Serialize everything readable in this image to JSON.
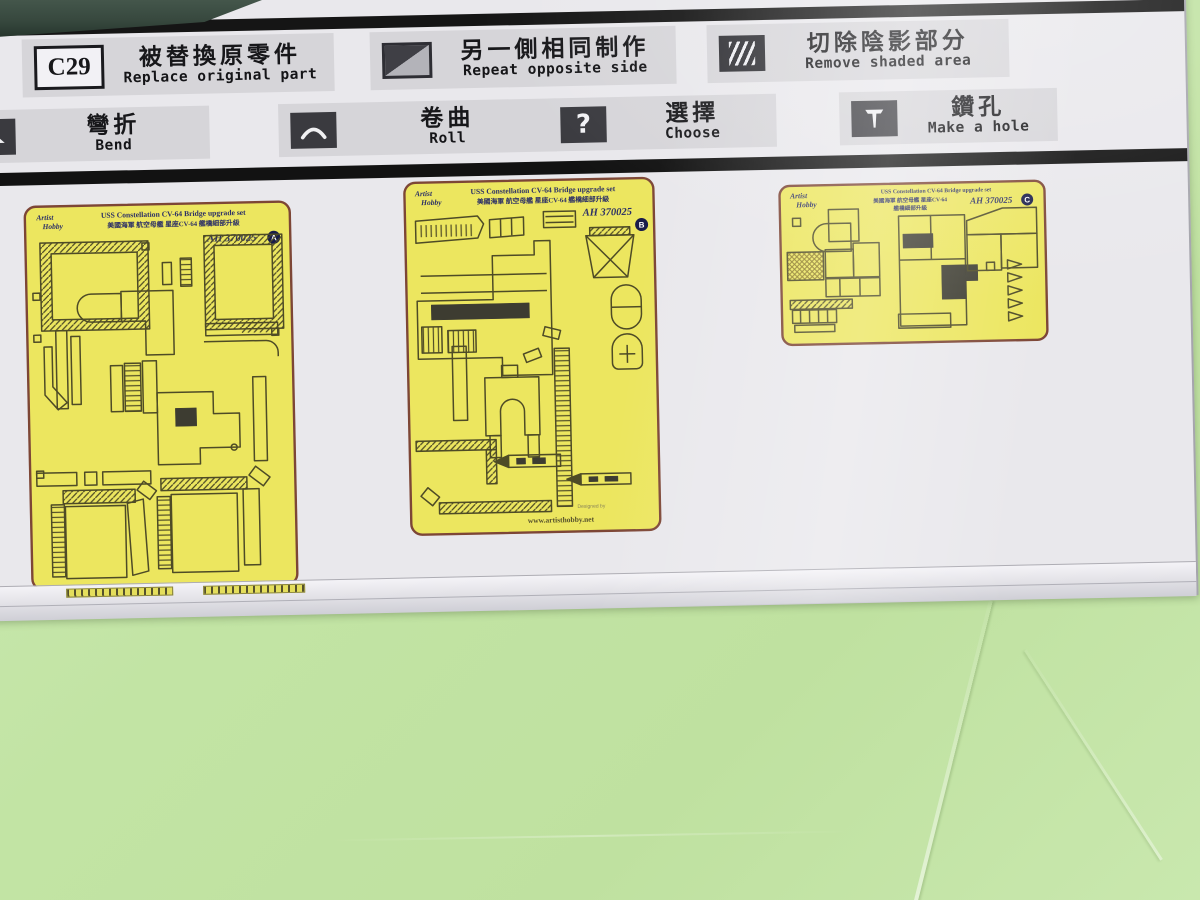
{
  "scene": {
    "background_color": "#c2e4a4",
    "sheet_color": "#e9e8ec",
    "fret_color": "#ece65f",
    "accent_navy": "#2c3066"
  },
  "legend": {
    "row1": [
      {
        "symbol": "C29",
        "zh": "被替換原零件",
        "en": "Replace original part",
        "icon": "part-number-box-icon"
      },
      {
        "zh": "另一側相同制作",
        "en": "Repeat opposite side",
        "icon": "diagonal-split-square-icon"
      },
      {
        "zh": "切除陰影部分",
        "en": "Remove shaded area",
        "icon": "hatched-square-icon"
      }
    ],
    "row2": [
      {
        "zh": "彎折",
        "en": "Bend",
        "icon": "bend-icon"
      },
      {
        "zh": "卷曲",
        "en": "Roll",
        "icon": "roll-icon"
      },
      {
        "zh": "選擇",
        "en": "Choose",
        "icon": "question-mark-icon",
        "glyph": "?"
      },
      {
        "zh": "鑽孔",
        "en": "Make a hole",
        "icon": "drill-icon"
      }
    ]
  },
  "frets": {
    "brand": {
      "line1": "Artist",
      "line2": "Hobby"
    },
    "a": {
      "title_en": "USS Constellation CV-64 Bridge upgrade set",
      "title_zh": "美國海軍 航空母艦 星座CV-64 艦橋細部升級",
      "code": "AH 370025",
      "sheet": "A"
    },
    "b": {
      "title_en": "USS Constellation CV-64 Bridge upgrade set",
      "title_zh": "美國海軍 航空母艦 星座CV-64 艦橋細部升級",
      "code": "AH 370025",
      "sheet": "B",
      "designed_by": "Designed by",
      "url": "www.artisthobby.net"
    },
    "c": {
      "title_en": "USS Constellation CV-64  Bridge upgrade set",
      "title_zh1": "美國海軍 航空母艦 星座CV-64",
      "title_zh2": "艦橋細部升級",
      "code": "AH 370025",
      "sheet": "C"
    }
  }
}
